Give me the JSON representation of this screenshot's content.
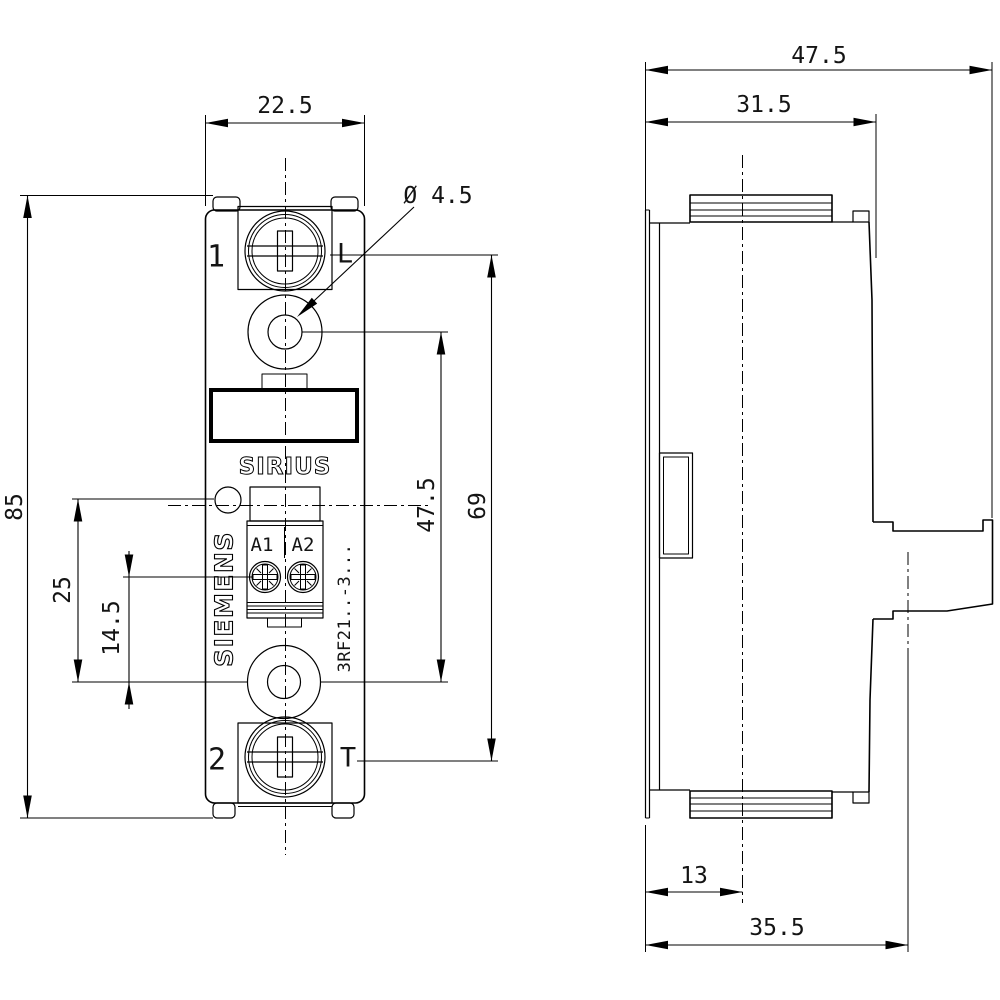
{
  "page": {
    "background": "#ffffff",
    "ink": "#000000",
    "kind": "technical dimensional drawing, front view and side view"
  },
  "drawing": {
    "front_view": {
      "labels": {
        "terminal_1": "1",
        "terminal_L": "L",
        "terminal_2": "2",
        "terminal_T": "T",
        "control_a1": "A1",
        "control_a2": "A2",
        "series": "SIRIUS",
        "brand": "SIEMENS",
        "model": "3RF21..-3..."
      },
      "dimensions": {
        "overall_width": "22.5",
        "overall_height": "85",
        "mounting_hole_diameter": "Ø 4.5",
        "led_to_lower_hole": "25",
        "coil_terminal_to_lower_hole": "14.5",
        "mounting_hole_spacing": "47.5",
        "main_terminal_spacing": "69"
      }
    },
    "side_view": {
      "dimensions": {
        "overall_depth": "47.5",
        "body_depth": "31.5",
        "front_to_din_center": "13",
        "front_to_din_rail": "35.5"
      }
    }
  }
}
